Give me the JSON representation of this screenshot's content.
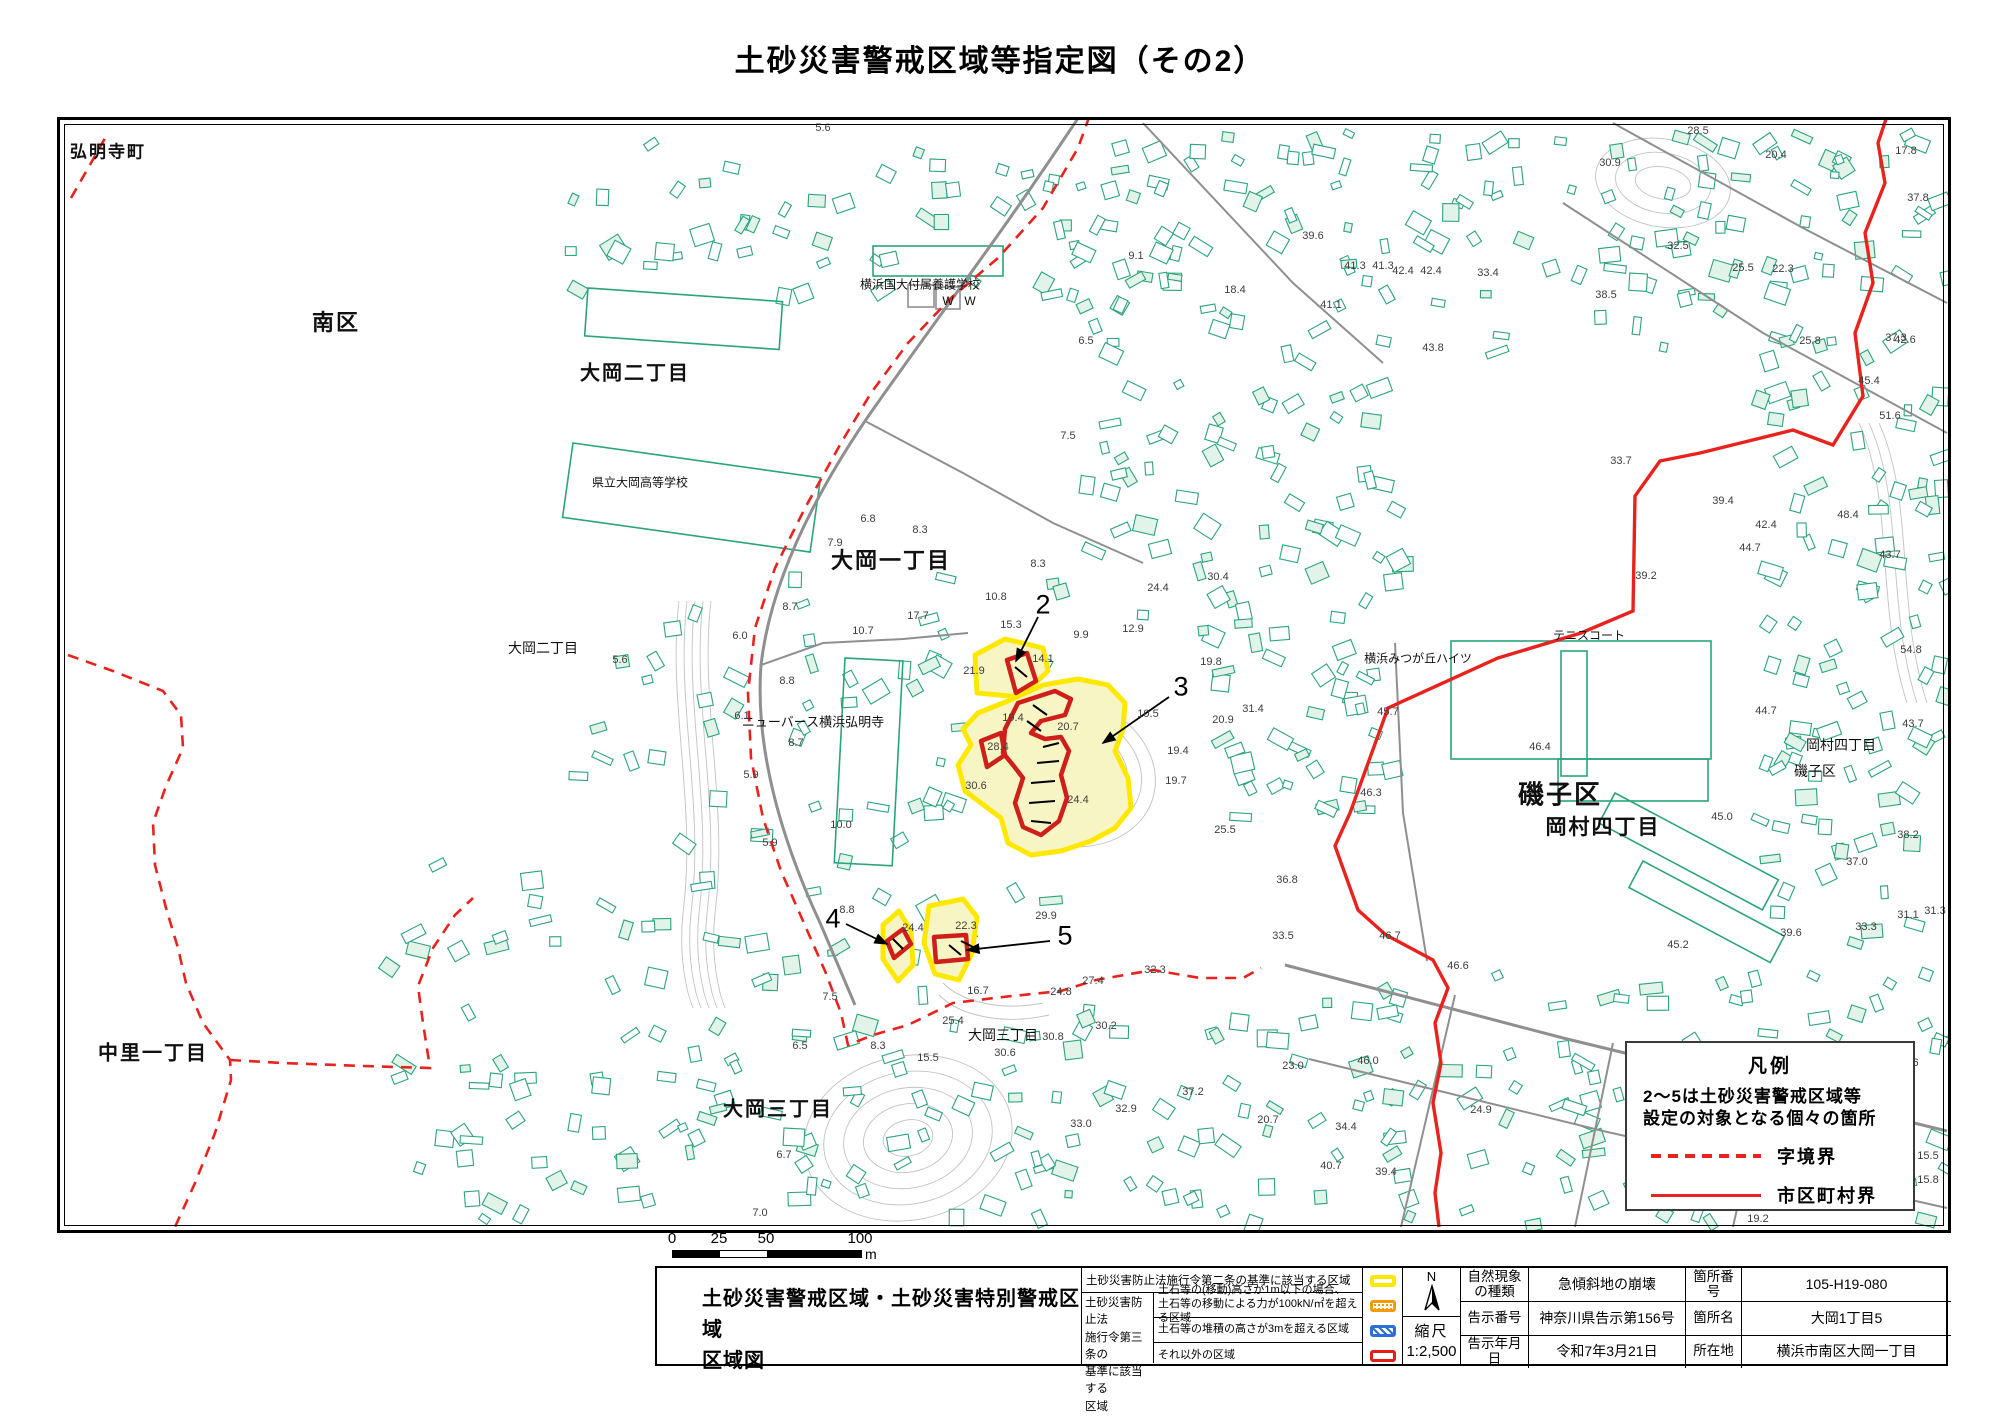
{
  "page_title": "土砂災害警戒区域等指定図（その2）",
  "legend_box": {
    "title": "凡例",
    "note1": "2～5は土砂災害警戒区域等",
    "note2": "設定の対象となる個々の箇所",
    "items": [
      {
        "label": "字境界",
        "style": "dashed"
      },
      {
        "label": "市区町村界",
        "style": "solid"
      }
    ]
  },
  "scale_bar": {
    "labels": [
      "0",
      "25",
      "50",
      "100"
    ],
    "unit": "m"
  },
  "footer": {
    "sheet_title_line1": "土砂災害警戒区域・土砂災害特別警戒区域",
    "sheet_title_line2": "区域図",
    "zone_table": {
      "row1_label": "土砂災害防止法施行令第二条の基準に該当する区域",
      "group_label_lines": [
        "土砂災害防止法",
        "施行令第三条の",
        "基準に該当する",
        "区域"
      ],
      "row2_label_line1": "土石等の(移動)高さが1m以下の場合、",
      "row2_label_line2": "土石等の移動による力が100kN/㎡を超える区域",
      "row3_label": "土石等の堆積の高さが3mを超える区域",
      "row4_label": "それ以外の区域"
    },
    "north_label": "N",
    "scale_caption": "縮尺",
    "scale_value": "1:2,500",
    "info_rows": [
      {
        "label": "自然現象の種類",
        "value": "急傾斜地の崩壊",
        "label2": "箇所番号",
        "value2": "105-H19-080"
      },
      {
        "label": "告示番号",
        "value": "神奈川県告示第156号",
        "label2": "箇所名",
        "value2": "大岡1丁目5"
      },
      {
        "label": "告示年月日",
        "value": "令和7年3月21日",
        "label2": "所在地",
        "value2": "横浜市南区大岡一丁目"
      }
    ]
  },
  "map": {
    "colors": {
      "building": "#2ba47c",
      "building_fill": "#e2f4ea",
      "road": "#8f8f8f",
      "contour": "#c2c2c2",
      "boundary_red": "#e8231d",
      "zone_yellow": "#ffe800",
      "zone_yellow_fill": "#f8f5c4",
      "zone_red": "#cf1f1a"
    },
    "place_labels": [
      {
        "t": "弘明寺町",
        "x": 105,
        "y": 147,
        "s": 17,
        "b": 1
      },
      {
        "t": "南区",
        "x": 333,
        "y": 318,
        "s": 22,
        "b": 1
      },
      {
        "t": "大岡二丁目",
        "x": 632,
        "y": 368,
        "s": 20,
        "b": 1
      },
      {
        "t": "横浜国大付属養護学校",
        "x": 917,
        "y": 281,
        "s": 12,
        "b": 0
      },
      {
        "t": "県立大岡高等学校",
        "x": 637,
        "y": 479,
        "s": 12,
        "b": 0
      },
      {
        "t": "大岡一丁目",
        "x": 888,
        "y": 556,
        "s": 22,
        "b": 1
      },
      {
        "t": "大岡二丁目",
        "x": 540,
        "y": 645,
        "s": 14,
        "b": 0
      },
      {
        "t": "ニューバース横浜弘明寺",
        "x": 810,
        "y": 718,
        "s": 13,
        "b": 0
      },
      {
        "t": "中里一丁目",
        "x": 150,
        "y": 1048,
        "s": 20,
        "b": 1
      },
      {
        "t": "大岡三丁目",
        "x": 775,
        "y": 1104,
        "s": 20,
        "b": 1
      },
      {
        "t": "大岡三丁目",
        "x": 1000,
        "y": 1032,
        "s": 14,
        "b": 0
      },
      {
        "t": "磯子区",
        "x": 1557,
        "y": 790,
        "s": 26,
        "b": 1
      },
      {
        "t": "岡村四丁目",
        "x": 1600,
        "y": 823,
        "s": 21,
        "b": 1
      },
      {
        "t": "テニスコート",
        "x": 1586,
        "y": 632,
        "s": 12,
        "b": 0
      },
      {
        "t": "横浜みつが丘ハイツ",
        "x": 1415,
        "y": 655,
        "s": 12,
        "b": 0
      },
      {
        "t": "岡村四丁目",
        "x": 1838,
        "y": 742,
        "s": 14,
        "b": 0
      },
      {
        "t": "磯子区",
        "x": 1812,
        "y": 768,
        "s": 14,
        "b": 0
      },
      {
        "t": "W",
        "x": 945,
        "y": 298,
        "s": 12,
        "b": 0
      },
      {
        "t": "W",
        "x": 967,
        "y": 298,
        "s": 12,
        "b": 0
      }
    ],
    "elevation_labels": [
      {
        "t": "5.6",
        "x": 820,
        "y": 125
      },
      {
        "t": "17.8",
        "x": 1903,
        "y": 148
      },
      {
        "t": "28.5",
        "x": 1695,
        "y": 128
      },
      {
        "t": "20.4",
        "x": 1773,
        "y": 152
      },
      {
        "t": "30.9",
        "x": 1607,
        "y": 160
      },
      {
        "t": "39.6",
        "x": 1310,
        "y": 233
      },
      {
        "t": "9.1",
        "x": 1133,
        "y": 253
      },
      {
        "t": "42.4",
        "x": 1400,
        "y": 268
      },
      {
        "t": "42.4",
        "x": 1428,
        "y": 268
      },
      {
        "t": "41.3",
        "x": 1352,
        "y": 263
      },
      {
        "t": "41.3",
        "x": 1380,
        "y": 263
      },
      {
        "t": "33.4",
        "x": 1485,
        "y": 270
      },
      {
        "t": "18.4",
        "x": 1232,
        "y": 287
      },
      {
        "t": "41.1",
        "x": 1328,
        "y": 302
      },
      {
        "t": "37.3",
        "x": 1893,
        "y": 335
      },
      {
        "t": "43.8",
        "x": 1430,
        "y": 345
      },
      {
        "t": "6.5",
        "x": 1083,
        "y": 338
      },
      {
        "t": "32.5",
        "x": 1675,
        "y": 243
      },
      {
        "t": "22.3",
        "x": 1780,
        "y": 266
      },
      {
        "t": "38.5",
        "x": 1603,
        "y": 292
      },
      {
        "t": "25.8",
        "x": 1807,
        "y": 338
      },
      {
        "t": "37.8",
        "x": 1915,
        "y": 195
      },
      {
        "t": "42.6",
        "x": 1902,
        "y": 337
      },
      {
        "t": "25.5",
        "x": 1740,
        "y": 265
      },
      {
        "t": "45.4",
        "x": 1866,
        "y": 378
      },
      {
        "t": "51.6",
        "x": 1887,
        "y": 413
      },
      {
        "t": "33.7",
        "x": 1618,
        "y": 458
      },
      {
        "t": "39.4",
        "x": 1720,
        "y": 498
      },
      {
        "t": "42.4",
        "x": 1763,
        "y": 522
      },
      {
        "t": "48.4",
        "x": 1845,
        "y": 512
      },
      {
        "t": "39.2",
        "x": 1643,
        "y": 573
      },
      {
        "t": "7.5",
        "x": 1065,
        "y": 433
      },
      {
        "t": "6.8",
        "x": 865,
        "y": 516
      },
      {
        "t": "8.3",
        "x": 917,
        "y": 527
      },
      {
        "t": "7.9",
        "x": 832,
        "y": 540
      },
      {
        "t": "8.3",
        "x": 1035,
        "y": 561
      },
      {
        "t": "10.8",
        "x": 993,
        "y": 594
      },
      {
        "t": "15.3",
        "x": 1008,
        "y": 622
      },
      {
        "t": "17.7",
        "x": 915,
        "y": 613
      },
      {
        "t": "8.7",
        "x": 787,
        "y": 604
      },
      {
        "t": "6.0",
        "x": 737,
        "y": 633
      },
      {
        "t": "10.7",
        "x": 860,
        "y": 628
      },
      {
        "t": "14.1",
        "x": 1040,
        "y": 656
      },
      {
        "t": "9.9",
        "x": 1078,
        "y": 632
      },
      {
        "t": "12.9",
        "x": 1130,
        "y": 626
      },
      {
        "t": "24.4",
        "x": 1155,
        "y": 585
      },
      {
        "t": "30.4",
        "x": 1215,
        "y": 574
      },
      {
        "t": "21.9",
        "x": 971,
        "y": 668
      },
      {
        "t": "19.8",
        "x": 1208,
        "y": 659
      },
      {
        "t": "19.4",
        "x": 1010,
        "y": 715
      },
      {
        "t": "20.7",
        "x": 1065,
        "y": 724
      },
      {
        "t": "10.5",
        "x": 1145,
        "y": 711
      },
      {
        "t": "28.4",
        "x": 995,
        "y": 744
      },
      {
        "t": "20.9",
        "x": 1220,
        "y": 717
      },
      {
        "t": "19.4",
        "x": 1175,
        "y": 748
      },
      {
        "t": "30.6",
        "x": 973,
        "y": 783
      },
      {
        "t": "19.7",
        "x": 1173,
        "y": 778
      },
      {
        "t": "24.4",
        "x": 1075,
        "y": 797
      },
      {
        "t": "25.5",
        "x": 1222,
        "y": 827
      },
      {
        "t": "31.4",
        "x": 1250,
        "y": 706
      },
      {
        "t": "8.8",
        "x": 784,
        "y": 678
      },
      {
        "t": "6.1",
        "x": 739,
        "y": 713
      },
      {
        "t": "8.7",
        "x": 793,
        "y": 740
      },
      {
        "t": "5.9",
        "x": 748,
        "y": 772
      },
      {
        "t": "10.0",
        "x": 838,
        "y": 822
      },
      {
        "t": "5.9",
        "x": 767,
        "y": 840
      },
      {
        "t": "45.7",
        "x": 1385,
        "y": 709
      },
      {
        "t": "46.4",
        "x": 1537,
        "y": 744
      },
      {
        "t": "44.7",
        "x": 1747,
        "y": 545
      },
      {
        "t": "43.7",
        "x": 1887,
        "y": 552
      },
      {
        "t": "54.8",
        "x": 1908,
        "y": 647
      },
      {
        "t": "46.3",
        "x": 1368,
        "y": 790
      },
      {
        "t": "36.8",
        "x": 1284,
        "y": 877
      },
      {
        "t": "33.5",
        "x": 1280,
        "y": 933
      },
      {
        "t": "46.7",
        "x": 1387,
        "y": 933
      },
      {
        "t": "46.6",
        "x": 1455,
        "y": 963
      },
      {
        "t": "45.0",
        "x": 1719,
        "y": 814
      },
      {
        "t": "44.7",
        "x": 1763,
        "y": 708
      },
      {
        "t": "43.7",
        "x": 1910,
        "y": 721
      },
      {
        "t": "38.2",
        "x": 1905,
        "y": 832
      },
      {
        "t": "37.0",
        "x": 1854,
        "y": 859
      },
      {
        "t": "45.2",
        "x": 1675,
        "y": 942
      },
      {
        "t": "39.6",
        "x": 1788,
        "y": 930
      },
      {
        "t": "33.3",
        "x": 1863,
        "y": 924
      },
      {
        "t": "31.1",
        "x": 1905,
        "y": 912
      },
      {
        "t": "31.3",
        "x": 1932,
        "y": 908
      },
      {
        "t": "8.8",
        "x": 844,
        "y": 907
      },
      {
        "t": "24.4",
        "x": 910,
        "y": 925
      },
      {
        "t": "22.3",
        "x": 963,
        "y": 923
      },
      {
        "t": "29.9",
        "x": 1043,
        "y": 913
      },
      {
        "t": "16.7",
        "x": 975,
        "y": 988
      },
      {
        "t": "25.4",
        "x": 950,
        "y": 1018
      },
      {
        "t": "7.5",
        "x": 827,
        "y": 994
      },
      {
        "t": "8.3",
        "x": 875,
        "y": 1043
      },
      {
        "t": "15.5",
        "x": 925,
        "y": 1055
      },
      {
        "t": "30.6",
        "x": 1002,
        "y": 1050
      },
      {
        "t": "27.4",
        "x": 1090,
        "y": 978
      },
      {
        "t": "24.8",
        "x": 1058,
        "y": 989
      },
      {
        "t": "32.3",
        "x": 1152,
        "y": 967
      },
      {
        "t": "30.2",
        "x": 1103,
        "y": 1023
      },
      {
        "t": "30.8",
        "x": 1050,
        "y": 1034
      },
      {
        "t": "37.2",
        "x": 1190,
        "y": 1089
      },
      {
        "t": "32.9",
        "x": 1123,
        "y": 1106
      },
      {
        "t": "33.0",
        "x": 1078,
        "y": 1121
      },
      {
        "t": "6.5",
        "x": 797,
        "y": 1043
      },
      {
        "t": "6.7",
        "x": 781,
        "y": 1152
      },
      {
        "t": "7.0",
        "x": 757,
        "y": 1210
      },
      {
        "t": "23.0",
        "x": 1290,
        "y": 1063
      },
      {
        "t": "34.4",
        "x": 1343,
        "y": 1124
      },
      {
        "t": "24.9",
        "x": 1653,
        "y": 1104
      },
      {
        "t": "24.9",
        "x": 1478,
        "y": 1107
      },
      {
        "t": "40.7",
        "x": 1328,
        "y": 1163
      },
      {
        "t": "39.4",
        "x": 1383,
        "y": 1169
      },
      {
        "t": "20.7",
        "x": 1265,
        "y": 1117
      },
      {
        "t": "46.0",
        "x": 1365,
        "y": 1058
      },
      {
        "t": "7.6",
        "x": 1908,
        "y": 1060
      },
      {
        "t": "15.5",
        "x": 1925,
        "y": 1153
      },
      {
        "t": "15.8",
        "x": 1925,
        "y": 1177
      },
      {
        "t": "19.2",
        "x": 1755,
        "y": 1216
      },
      {
        "t": "5.6",
        "x": 617,
        "y": 657
      }
    ],
    "markers": [
      {
        "num": "2",
        "x": 1040,
        "y": 602,
        "x1": 1035,
        "y1": 614,
        "x2": 1013,
        "y2": 658
      },
      {
        "num": "3",
        "x": 1178,
        "y": 684,
        "x1": 1166,
        "y1": 694,
        "x2": 1100,
        "y2": 740
      },
      {
        "num": "4",
        "x": 830,
        "y": 916,
        "x1": 843,
        "y1": 921,
        "x2": 884,
        "y2": 941
      },
      {
        "num": "5",
        "x": 1062,
        "y": 933,
        "x1": 1047,
        "y1": 938,
        "x2": 964,
        "y2": 947
      }
    ]
  }
}
